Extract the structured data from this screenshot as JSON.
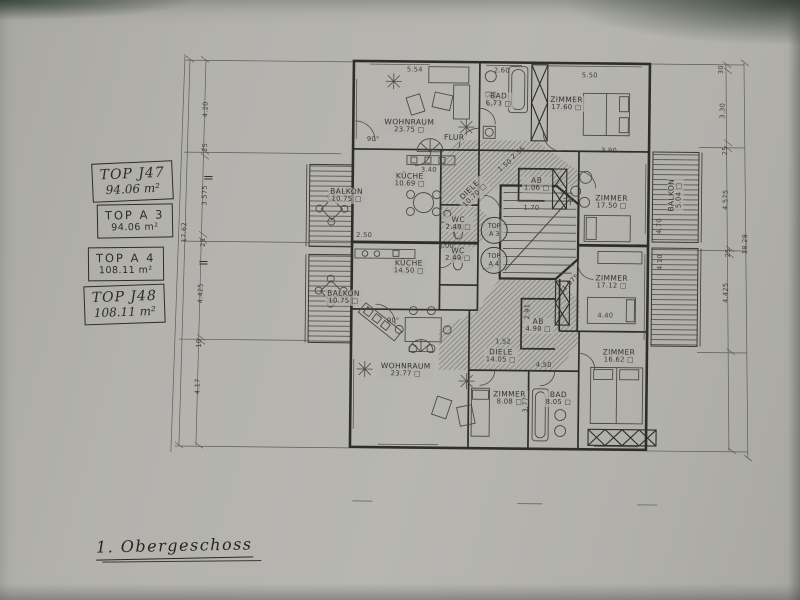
{
  "sheet": {
    "title": "1. Obergeschoss",
    "equals": "=",
    "paper_color": "#b3b2ad",
    "ink_color": "#34342e"
  },
  "legend": [
    {
      "line1": "TOP J47",
      "line2": "94.06 m²",
      "style": "hand"
    },
    {
      "line1": "TOP A 3",
      "line2": "94.06 m²",
      "style": "print"
    },
    {
      "line1": "TOP A 4",
      "line2": "108.11 m²",
      "style": "print"
    },
    {
      "line1": "TOP J48",
      "line2": "108.11 m²",
      "style": "hand"
    }
  ],
  "rooms": [
    {
      "name": "WOHNRAUM",
      "area": "23.75 □",
      "x": 408,
      "y": 127
    },
    {
      "name": "BAD",
      "area": "6.73 □",
      "x": 497,
      "y": 100
    },
    {
      "name": "ZIMMER",
      "area": "17.60 □",
      "x": 565,
      "y": 103
    },
    {
      "name": "KÜCHE",
      "area": "10.69 □",
      "x": 409,
      "y": 181
    },
    {
      "name": "BALKON",
      "area": "10.75 □",
      "x": 346,
      "y": 197
    },
    {
      "name": "WC",
      "area": "2.49 □",
      "x": 458,
      "y": 224
    },
    {
      "name": "DIELE",
      "area": "10.70 □",
      "x": 472,
      "y": 193,
      "rot": -45
    },
    {
      "name": "AB",
      "area": "1.06 □",
      "x": 536,
      "y": 184
    },
    {
      "name": "ZIMMER",
      "area": "17.50 □",
      "x": 611,
      "y": 201
    },
    {
      "name": "BALKON",
      "area": "5.04 □",
      "x": 675,
      "y": 193,
      "rot": -90
    },
    {
      "name": "FLUR",
      "area": "",
      "x": 453,
      "y": 138
    },
    {
      "name": "WC",
      "area": "2.49 □",
      "x": 458,
      "y": 255
    },
    {
      "name": "KÜCHE",
      "area": "14.50 □",
      "x": 409,
      "y": 268
    },
    {
      "name": "BALKON",
      "area": "10.75 □",
      "x": 344,
      "y": 299
    },
    {
      "name": "WOHNRAUM",
      "area": "23.77 □",
      "x": 407,
      "y": 371
    },
    {
      "name": "DIELE",
      "area": "14.05 □",
      "x": 502,
      "y": 356
    },
    {
      "name": "AB",
      "area": "4.98 □",
      "x": 539,
      "y": 325
    },
    {
      "name": "ZIMMER",
      "area": "17.12 □",
      "x": 612,
      "y": 281
    },
    {
      "name": "ZIMMER",
      "area": "16.62 □",
      "x": 620,
      "y": 355
    },
    {
      "name": "ZIMMER",
      "area": "8.08 □",
      "x": 511,
      "y": 398
    },
    {
      "name": "BAD",
      "area": "8.05 □",
      "x": 560,
      "y": 398
    }
  ],
  "stair_tags": [
    {
      "l1": "TOP",
      "l2": "A 3",
      "x": 494,
      "y": 230
    },
    {
      "l1": "TOP",
      "l2": "A 4",
      "x": 494,
      "y": 260
    }
  ],
  "dimensions": [
    {
      "text": "5.54",
      "x": 413,
      "y": 70
    },
    {
      "text": "2.60",
      "x": 500,
      "y": 70
    },
    {
      "text": "5.50",
      "x": 588,
      "y": 74
    },
    {
      "text": "3.40",
      "x": 428,
      "y": 170
    },
    {
      "text": "2.55",
      "x": 517,
      "y": 152,
      "rot": -40
    },
    {
      "text": "1.50",
      "x": 504,
      "y": 165,
      "rot": -40
    },
    {
      "text": "3.90",
      "x": 608,
      "y": 149
    },
    {
      "text": "1.70",
      "x": 531,
      "y": 207
    },
    {
      "text": "2.50",
      "x": 364,
      "y": 236
    },
    {
      "text": "3.00",
      "x": 446,
      "y": 246
    },
    {
      "text": "1.52",
      "x": 504,
      "y": 341
    },
    {
      "text": "4.50",
      "x": 545,
      "y": 364
    },
    {
      "text": "4.40",
      "x": 606,
      "y": 314
    },
    {
      "text": "2.91",
      "x": 528,
      "y": 311,
      "rot": -90
    },
    {
      "text": "1.975",
      "x": 571,
      "y": 281,
      "rot": -45
    },
    {
      "text": "3.77",
      "x": 527,
      "y": 404,
      "rot": -90
    },
    {
      "text": "90°",
      "x": 372,
      "y": 140
    },
    {
      "text": "90°",
      "x": 394,
      "y": 321
    },
    {
      "text": "4.70",
      "x": 659,
      "y": 224,
      "rot": -90
    },
    {
      "text": "4.10",
      "x": 660,
      "y": 260,
      "rot": -90
    },
    {
      "text": "4.20",
      "x": 204,
      "y": 112,
      "rot": -90
    },
    {
      "text": "25",
      "x": 204,
      "y": 150,
      "rot": -90
    },
    {
      "text": "3.575",
      "x": 204,
      "y": 198,
      "rot": -90
    },
    {
      "text": "25",
      "x": 203,
      "y": 245,
      "rot": -90
    },
    {
      "text": "4.425",
      "x": 201,
      "y": 296,
      "rot": -90
    },
    {
      "text": "10",
      "x": 200,
      "y": 346,
      "rot": -90
    },
    {
      "text": "4.17",
      "x": 199,
      "y": 389,
      "rot": -90
    },
    {
      "text": "17.62",
      "x": 184,
      "y": 235,
      "rot": -90
    },
    {
      "text": "30",
      "x": 719,
      "y": 67,
      "rot": -90
    },
    {
      "text": "3.30",
      "x": 721,
      "y": 108,
      "rot": -90
    },
    {
      "text": "25",
      "x": 724,
      "y": 148,
      "rot": -90
    },
    {
      "text": "4.575",
      "x": 725,
      "y": 197,
      "rot": -90
    },
    {
      "text": "25",
      "x": 728,
      "y": 250,
      "rot": -90
    },
    {
      "text": "4.425",
      "x": 726,
      "y": 290,
      "rot": -90
    },
    {
      "text": "18.28",
      "x": 745,
      "y": 241,
      "rot": -90
    }
  ]
}
